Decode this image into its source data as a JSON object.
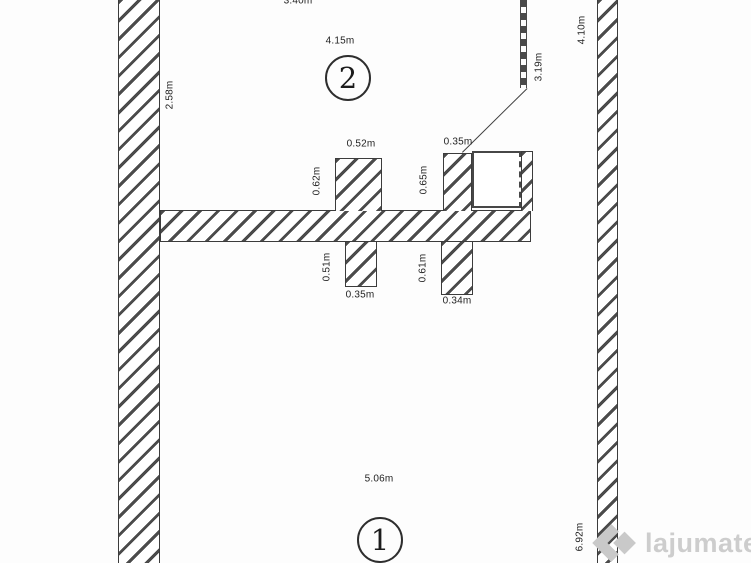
{
  "plan": {
    "dims": {
      "top_width": "3.40m",
      "room2_width": "4.15m",
      "left_upper_height": "2.58m",
      "partition_height": "3.19m",
      "right_upper_height": "4.10m",
      "stub_a_width": "0.52m",
      "stub_a_height": "0.62m",
      "stub_b_width": "0.35m",
      "stub_b_height": "0.65m",
      "stub_c_height": "0.51m",
      "stub_c_width": "0.35m",
      "stub_d_height": "0.61m",
      "stub_d_width": "0.34m",
      "room1_width": "5.06m",
      "right_lower_height": "6.92m"
    },
    "rooms": {
      "room1": {
        "number": "1"
      },
      "room2": {
        "number": "2"
      }
    }
  },
  "watermark": {
    "name": "lajumate",
    "tld": ".ro"
  },
  "colors": {
    "wall_line": "#4b4b4b",
    "wall_border": "#3c3c3c",
    "text": "#1f1f1f",
    "watermark_name": "#cdcdcd",
    "watermark_tld": "#9e9e9e",
    "background": "#fdfdfd"
  }
}
